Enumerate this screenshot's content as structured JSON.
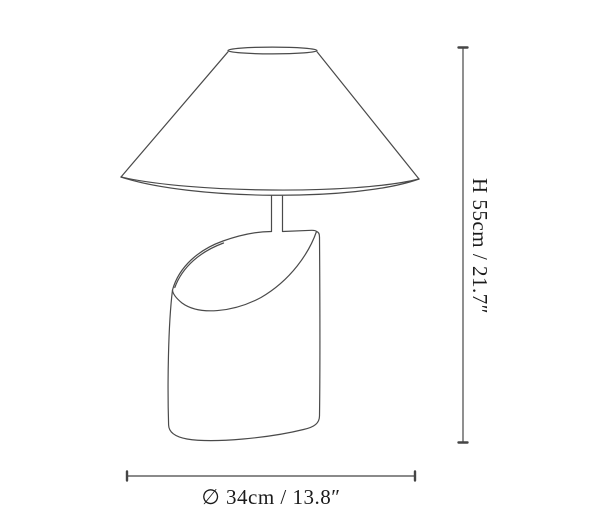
{
  "figure": {
    "subject": "Table lamp technical line drawing with dimension lines",
    "height_dimension": {
      "label": "H 55cm / 21.7″"
    },
    "width_dimension": {
      "label": "∅ 34cm / 13.8″"
    }
  },
  "parts": {
    "lampshade": "conical lampshade outline",
    "stem": "lamp stem",
    "base": "cylindrical base with curved diagonal cut"
  },
  "colors": {
    "line": "#4a4a4a",
    "text": "#1b1b1b",
    "background": "#ffffff"
  }
}
